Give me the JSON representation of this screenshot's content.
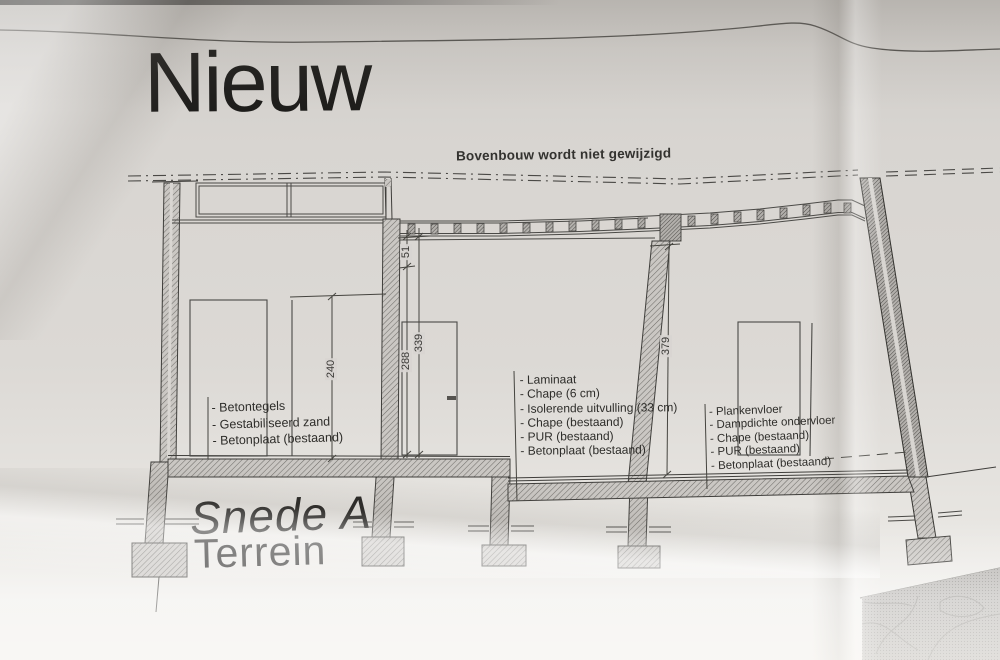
{
  "title": "Nieuw",
  "section": {
    "label": "Snede A",
    "sublabel": "Terrein"
  },
  "annotations": {
    "top_note": "Bovenbouw wordt niet gewijzigd",
    "left_layers": {
      "items": [
        "- Betontegels",
        "- Gestabiliseerd zand",
        "- Betonplaat (bestaand)"
      ]
    },
    "middle_layers": {
      "items": [
        "- Laminaat",
        "- Chape (6 cm)",
        "- Isolerende uitvulling (33 cm)",
        "- Chape (bestaand)",
        "- PUR (bestaand)",
        "- Betonplaat (bestaand)"
      ]
    },
    "right_layers": {
      "items": [
        "- Plankenvloer",
        "- Dampdichte ondervloer",
        "- Chape (bestaand)",
        "- PUR (bestaand)",
        "- Betonplaat (bestaand)"
      ]
    }
  },
  "dimensions": {
    "d240": "240",
    "d288": "288",
    "d339": "339",
    "d51": "51",
    "d379": "379"
  },
  "colors": {
    "paper": "#d8d5d1",
    "ink": "#3f3e3b",
    "hatch": "#716f6b"
  }
}
